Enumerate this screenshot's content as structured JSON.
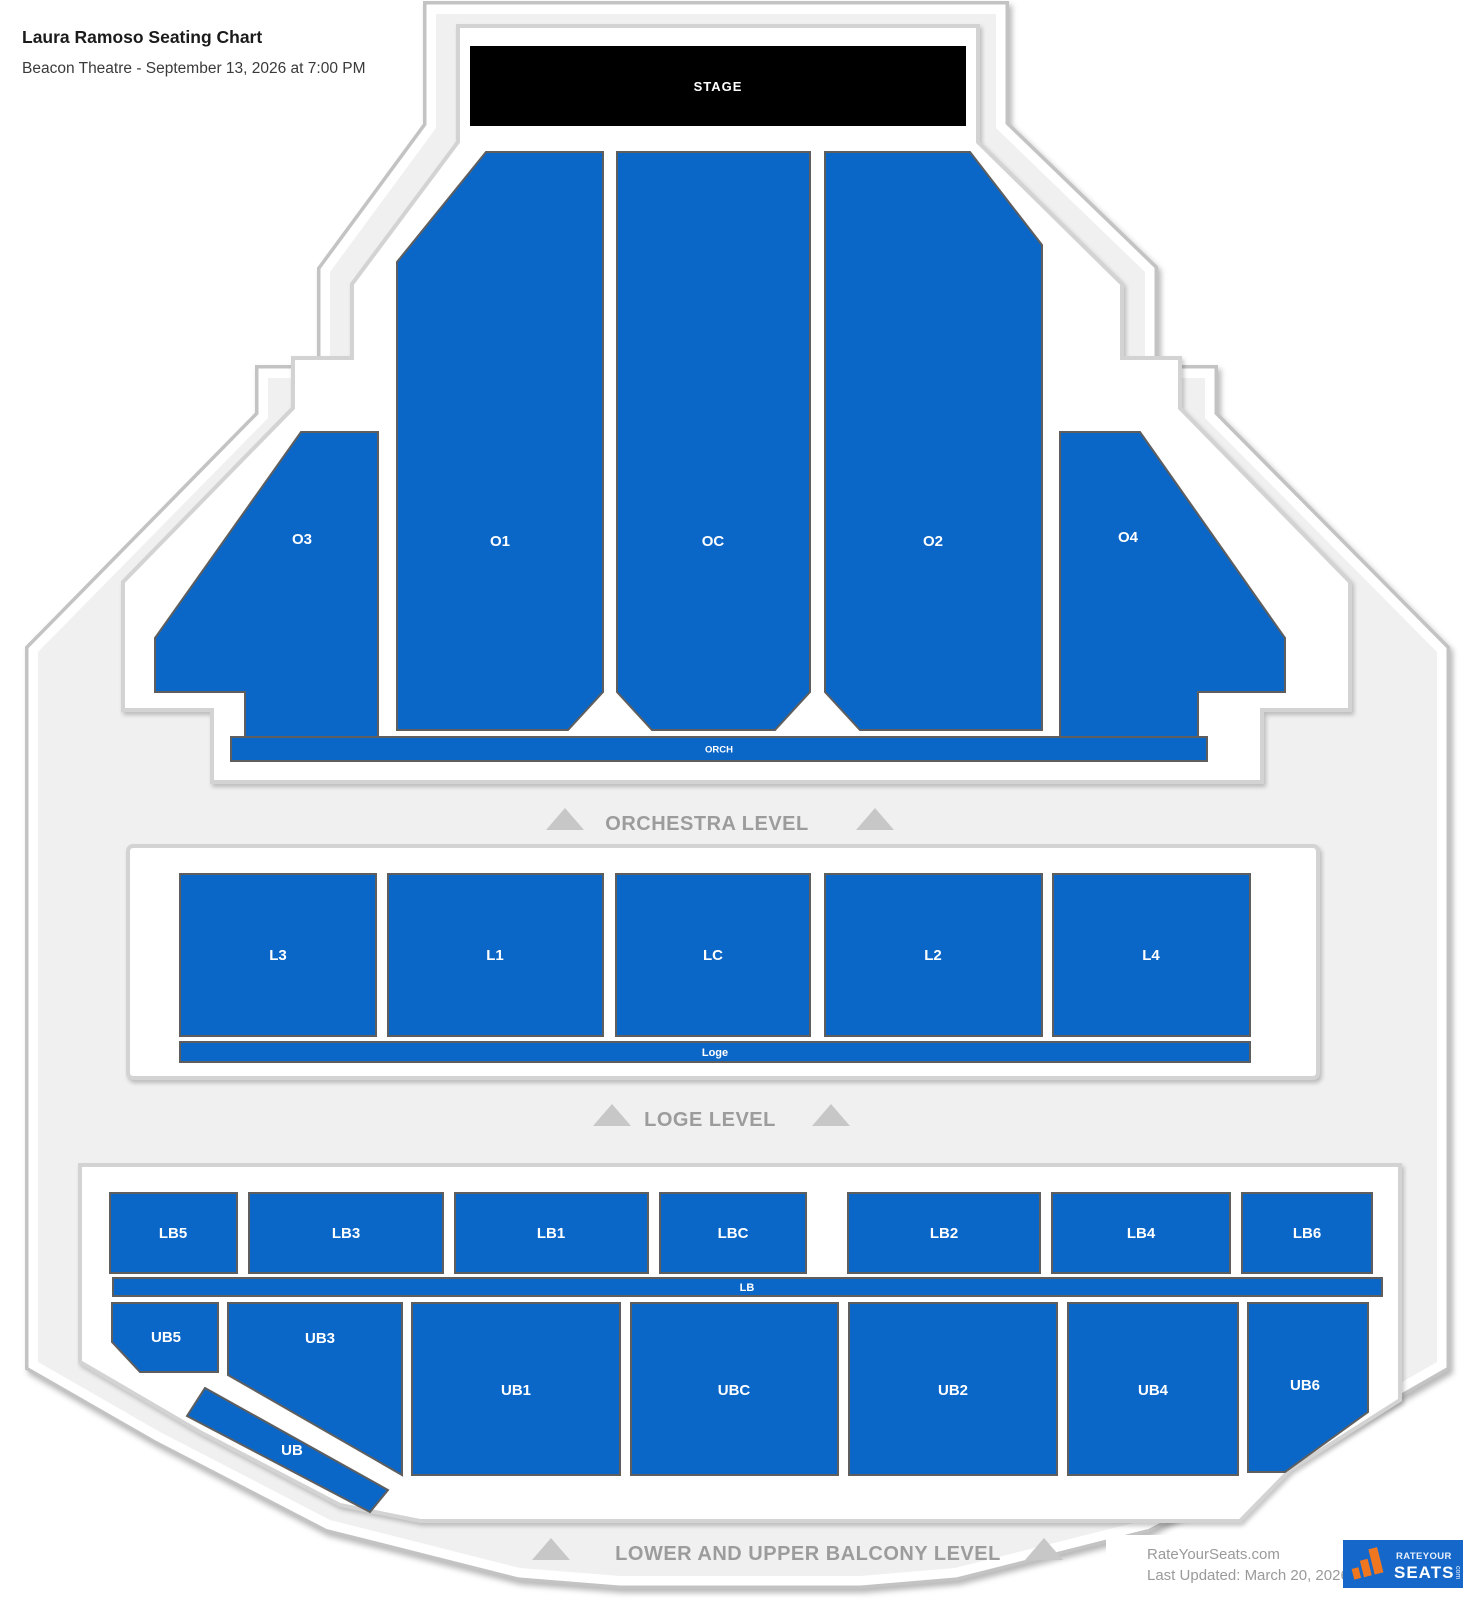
{
  "header": {
    "title": "Laura Ramoso Seating Chart",
    "subtitle": "Beacon Theatre - September 13, 2026 at 7:00 PM"
  },
  "stage_label": "STAGE",
  "banners": {
    "orchestra": "ORCHESTRA LEVEL",
    "loge": "LOGE LEVEL",
    "balcony": "LOWER AND UPPER BALCONY LEVEL"
  },
  "sections": {
    "orchestra": {
      "O3": "O3",
      "O1": "O1",
      "OC": "OC",
      "O2": "O2",
      "O4": "O4",
      "bar": "ORCH"
    },
    "loge": {
      "L3": "L3",
      "L1": "L1",
      "LC": "LC",
      "L2": "L2",
      "L4": "L4",
      "bar": "Loge"
    },
    "lower_balcony": {
      "LB5": "LB5",
      "LB3": "LB3",
      "LB1": "LB1",
      "LBC": "LBC",
      "LB2": "LB2",
      "LB4": "LB4",
      "LB6": "LB6",
      "bar": "LB"
    },
    "upper_balcony": {
      "UB5": "UB5",
      "UB3": "UB3",
      "UB1": "UB1",
      "UBC": "UBC",
      "UB2": "UB2",
      "UB4": "UB4",
      "UB6": "UB6",
      "bar": "UB"
    }
  },
  "footer": {
    "site": "RateYourSeats.com",
    "updated": "Last Updated: March 20, 2026",
    "logo_top": "RATEYOUR",
    "logo_main": "SEATS",
    "logo_suffix": "com"
  },
  "colors": {
    "section_fill": "#0b67c7",
    "section_border": "#5e5e5e",
    "venue_fill": "#f0f0f0",
    "venue_ring": "#c3c3c3",
    "banner_text": "#9c9c9c",
    "triangle": "#c7c7c7",
    "stage_bg": "#000000",
    "logo_bg": "#1568c9",
    "logo_accent": "#f0761f"
  }
}
